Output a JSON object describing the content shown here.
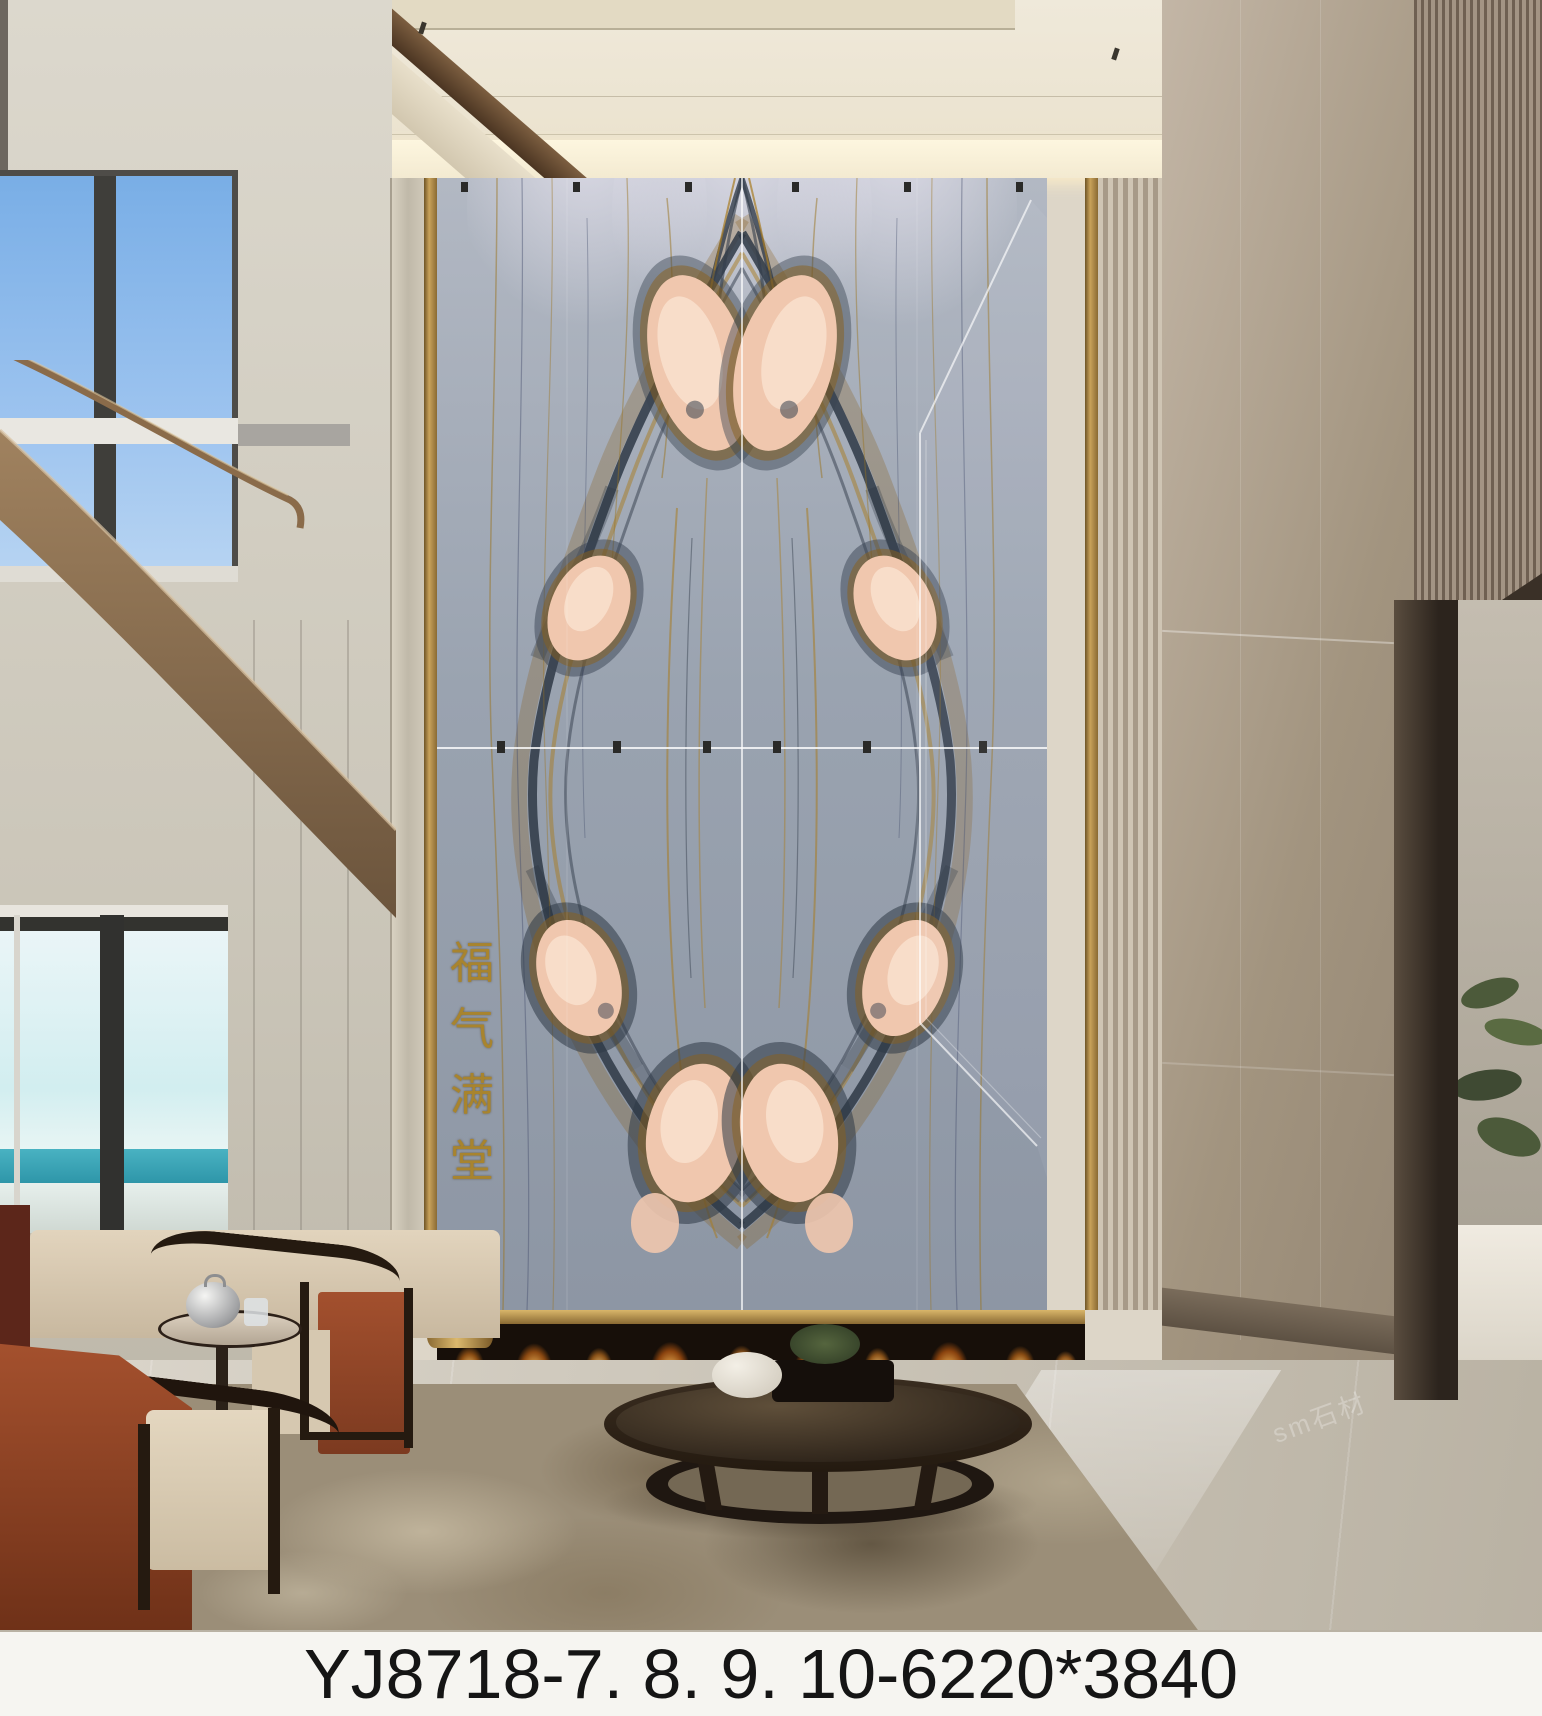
{
  "caption": {
    "text": "YJ8718-7. 8. 9. 10-6220*3840",
    "background": "#f6f5f1",
    "text_color": "#151515"
  },
  "marble_wall": {
    "inscription": {
      "text": "福气满堂",
      "chars": [
        "福",
        "气",
        "满",
        "堂"
      ],
      "color": "#a8842e"
    },
    "palette": {
      "base": "#98a1ae",
      "light": "#b9c0cb",
      "dark_vein": "#333d4b",
      "gold_vein": "#a87c22",
      "peach": "#f2cbb2",
      "frame_gold": "#b08d4f",
      "seam_line": "#ffffff"
    }
  },
  "scene": {
    "watermark": "sm石材",
    "ceiling_color": "#ece4d2",
    "left_wall_color": "#d6d2c8",
    "right_wall_color": "#a99c8c",
    "sky_color": "#8fc0ee",
    "sea_color": "#35a2b5",
    "wood_color": "#8a6f52",
    "red_chair_color": "#9c4a2c",
    "cushion_color": "#dbcfb9",
    "rug_color": "#9a8d77",
    "floor_color": "#cdc5b5",
    "fire_color": "#ffb347",
    "plant_color": "#4c5a3a"
  }
}
